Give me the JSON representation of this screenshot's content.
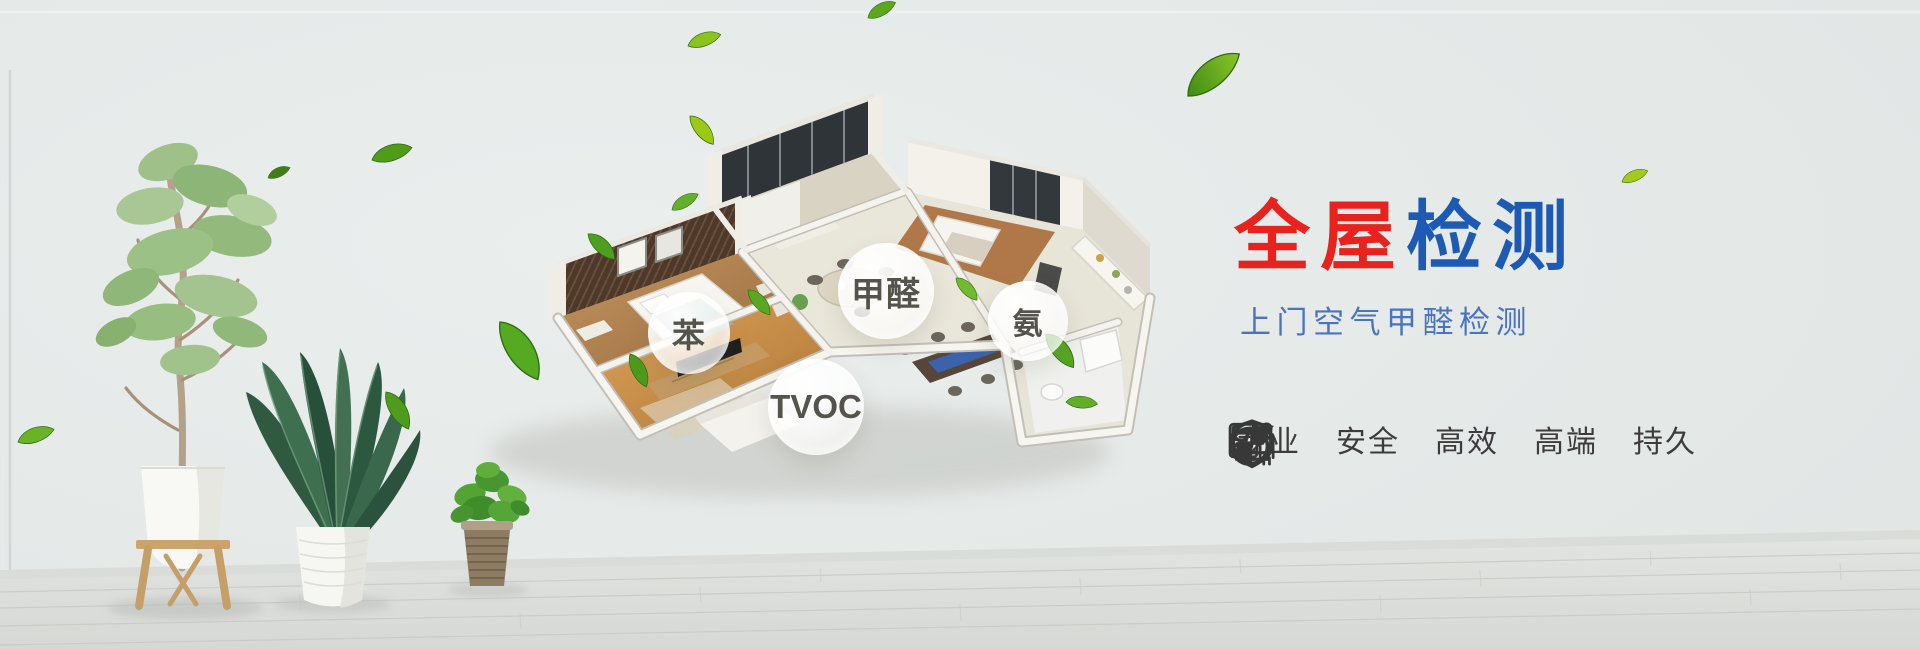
{
  "hero": {
    "title": {
      "part1": "全屋",
      "part2": "检测"
    },
    "subtitle": "上门空气甲醛检测",
    "features": [
      {
        "icon": "certificate-person-icon",
        "label": "专业"
      },
      {
        "icon": "shield-icon",
        "label": "安全"
      },
      {
        "icon": "gauge-arrow-icon",
        "label": "高效"
      },
      {
        "icon": "crown-icon",
        "label": "高端"
      },
      {
        "icon": "clock-icon",
        "label": "持久"
      }
    ],
    "pollutant_bubbles": [
      {
        "id": "benzene",
        "label": "苯"
      },
      {
        "id": "formaldehyde",
        "label": "甲醛"
      },
      {
        "id": "ammonia",
        "label": "氨"
      },
      {
        "id": "tvoc",
        "label": "TVOC"
      }
    ],
    "colors": {
      "title_red": "#e8231e",
      "title_blue": "#1d5ab4",
      "subtitle_blue": "#4a74bf",
      "icon_dark": "#383838",
      "label_dark": "#3c3c3c",
      "leaf_green": "#57a31c"
    }
  }
}
